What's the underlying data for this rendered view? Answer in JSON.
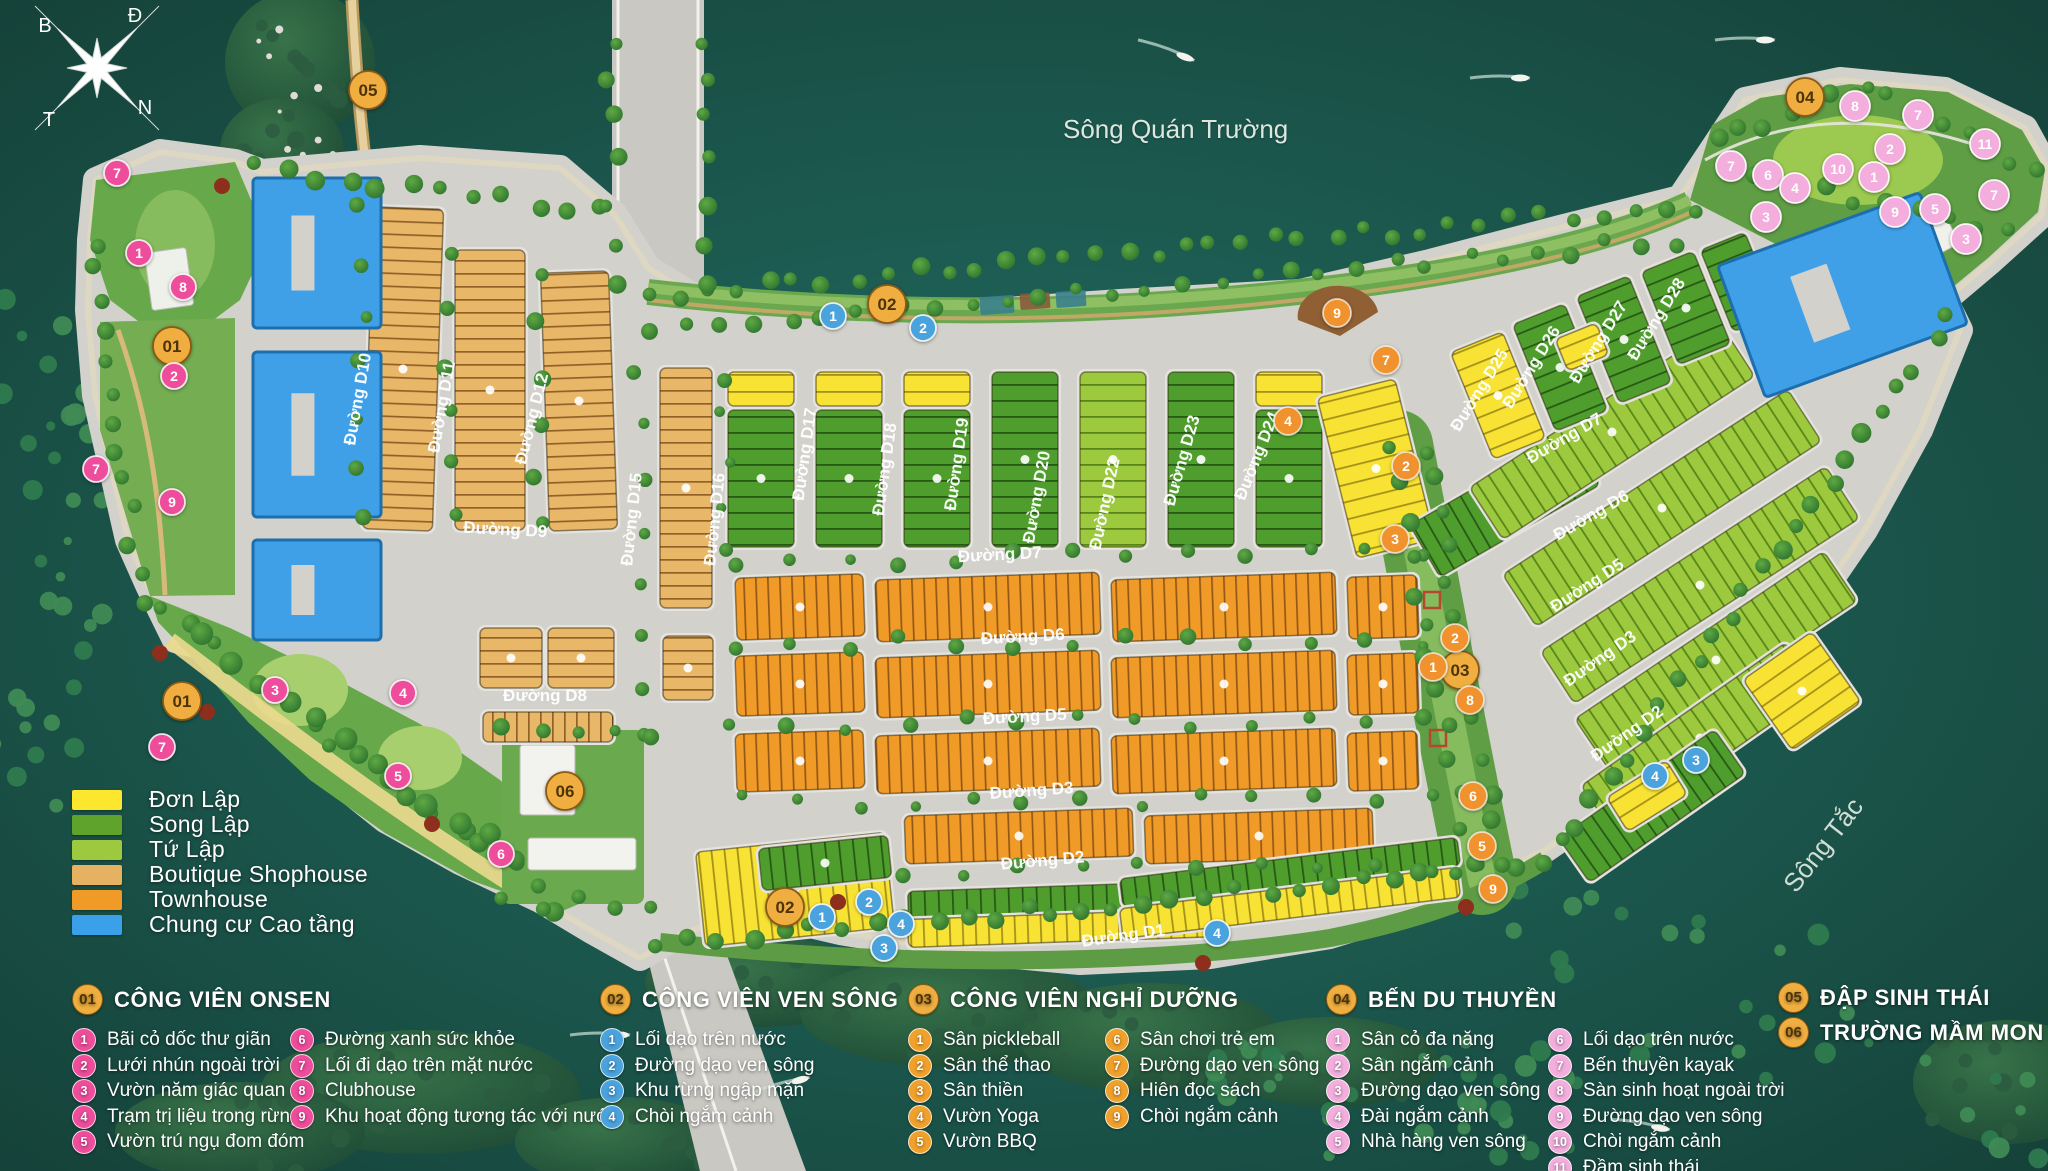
{
  "map": {
    "river_top": "Sông Quán Trường",
    "river_right": "Sông Tắc",
    "compass": {
      "top_left": "B",
      "top_right": "Đ",
      "bottom_left": "T",
      "bottom_right": "N"
    }
  },
  "legend": {
    "items": [
      {
        "label": "Đơn Lập",
        "color": "#fce62e"
      },
      {
        "label": "Song Lập",
        "color": "#5fa32c"
      },
      {
        "label": "Tứ Lập",
        "color": "#9cc93e"
      },
      {
        "label": "Boutique Shophouse",
        "color": "#e6b261"
      },
      {
        "label": "Townhouse",
        "color": "#f09b27"
      },
      {
        "label": "Chung cư Cao tầng",
        "color": "#3ba0ea"
      }
    ]
  },
  "poi_sections": [
    {
      "id": "01",
      "title": "CÔNG VIÊN ONSEN",
      "badge_color": "#ee4d9b",
      "items": [
        "Bãi cỏ dốc thư giãn",
        "Lưới nhún ngoài trời",
        "Vườn năm giác quan",
        "Trạm trị liệu trong rừng",
        "Vườn trú ngụ đom đóm",
        "Đường xanh sức khỏe",
        "Lối đi dạo trên mặt nước",
        "Clubhouse",
        "Khu hoạt động tương tác với nước"
      ]
    },
    {
      "id": "02",
      "title": "CÔNG VIÊN VEN SÔNG",
      "badge_color": "#4aa3dd",
      "items": [
        "Lối dạo trên nước",
        "Đường dạo ven sông",
        "Khu rừng ngập mặn",
        "Chòi ngắm cảnh"
      ]
    },
    {
      "id": "03",
      "title": "CÔNG VIÊN NGHỈ DƯỠNG",
      "badge_color": "#f0a12c",
      "items": [
        "Sân pickleball",
        "Sân thể thao",
        "Sân thiền",
        "Vườn Yoga",
        "Vườn BBQ",
        "Sân chơi trẻ em",
        "Đường dạo ven sông",
        "Hiên đọc sách",
        "Chòi ngắm cảnh"
      ]
    },
    {
      "id": "04",
      "title": "BẾN DU THUYỀN",
      "badge_color": "#f3aedd",
      "items": [
        "Sân cỏ đa năng",
        "Sân ngắm cảnh",
        "Đường dạo ven sông",
        "Đài ngắm cảnh",
        "Nhà hàng ven sông",
        "Lối dạo trên nước",
        "Bến thuyền kayak",
        "Sàn sinh hoạt ngoài trời",
        "Đường dạo ven sông",
        "Chòi ngắm cảnh",
        "Đầm sinh thái"
      ]
    },
    {
      "id": "05",
      "title": "ĐẬP SINH THÁI",
      "badge_color": "#efae3f",
      "items": []
    },
    {
      "id": "06",
      "title": "TRƯỜNG MẦM MON",
      "badge_color": "#efae3f",
      "items": []
    }
  ],
  "roads": {
    "d1": "Đường D1",
    "d2": "Đường D2",
    "d3": "Đường D3",
    "d5": "Đường D5",
    "d6": "Đường D6",
    "d7": "Đường D7",
    "d8": "Đường D8",
    "d9": "Đường D9",
    "d10": "Đường D10",
    "d11": "Đường D11",
    "d12": "Đường D12",
    "d15": "Đường D15",
    "d16": "Đường D16",
    "d17": "Đường D17",
    "d18": "Đường D18",
    "d19": "Đường D19",
    "d20": "Đường D20",
    "d22": "Đường D22",
    "d23": "Đường D23",
    "d24": "Đường D24",
    "d25": "Đường D25",
    "d26": "Đường D26",
    "d27": "Đường D27",
    "d28": "Đường D28"
  },
  "markers": {
    "gold": [
      {
        "n": "01",
        "x": 172,
        "y": 346
      },
      {
        "n": "01",
        "x": 182,
        "y": 701
      },
      {
        "n": "02",
        "x": 887,
        "y": 304
      },
      {
        "n": "02",
        "x": 785,
        "y": 907
      },
      {
        "n": "03",
        "x": 1460,
        "y": 670
      },
      {
        "n": "04",
        "x": 1805,
        "y": 97
      },
      {
        "n": "05",
        "x": 368,
        "y": 90
      },
      {
        "n": "06",
        "x": 565,
        "y": 791
      }
    ],
    "pink": [
      {
        "n": "7",
        "x": 117,
        "y": 173
      },
      {
        "n": "1",
        "x": 139,
        "y": 253
      },
      {
        "n": "8",
        "x": 183,
        "y": 287
      },
      {
        "n": "2",
        "x": 174,
        "y": 376
      },
      {
        "n": "7",
        "x": 96,
        "y": 469
      },
      {
        "n": "9",
        "x": 172,
        "y": 502
      },
      {
        "n": "3",
        "x": 275,
        "y": 690
      },
      {
        "n": "4",
        "x": 403,
        "y": 693
      },
      {
        "n": "5",
        "x": 398,
        "y": 776
      },
      {
        "n": "7",
        "x": 162,
        "y": 747
      },
      {
        "n": "6",
        "x": 501,
        "y": 854
      }
    ],
    "blue": [
      {
        "n": "1",
        "x": 833,
        "y": 316
      },
      {
        "n": "2",
        "x": 923,
        "y": 328
      },
      {
        "n": "1",
        "x": 822,
        "y": 917
      },
      {
        "n": "2",
        "x": 869,
        "y": 902
      },
      {
        "n": "3",
        "x": 884,
        "y": 948
      },
      {
        "n": "4",
        "x": 901,
        "y": 924
      },
      {
        "n": "4",
        "x": 1217,
        "y": 933
      },
      {
        "n": "3",
        "x": 1696,
        "y": 760
      },
      {
        "n": "4",
        "x": 1655,
        "y": 776
      }
    ],
    "orange": [
      {
        "n": "9",
        "x": 1337,
        "y": 313
      },
      {
        "n": "7",
        "x": 1386,
        "y": 360
      },
      {
        "n": "4",
        "x": 1288,
        "y": 421
      },
      {
        "n": "2",
        "x": 1406,
        "y": 466
      },
      {
        "n": "3",
        "x": 1395,
        "y": 539
      },
      {
        "n": "2",
        "x": 1455,
        "y": 638
      },
      {
        "n": "1",
        "x": 1433,
        "y": 667
      },
      {
        "n": "8",
        "x": 1470,
        "y": 700
      },
      {
        "n": "6",
        "x": 1473,
        "y": 796
      },
      {
        "n": "5",
        "x": 1482,
        "y": 846
      },
      {
        "n": "9",
        "x": 1493,
        "y": 889
      }
    ],
    "marina": [
      {
        "n": "8",
        "x": 1855,
        "y": 106
      },
      {
        "n": "7",
        "x": 1918,
        "y": 115
      },
      {
        "n": "11",
        "x": 1985,
        "y": 144
      },
      {
        "n": "7",
        "x": 1731,
        "y": 166
      },
      {
        "n": "6",
        "x": 1768,
        "y": 175
      },
      {
        "n": "2",
        "x": 1890,
        "y": 149
      },
      {
        "n": "10",
        "x": 1838,
        "y": 169
      },
      {
        "n": "1",
        "x": 1874,
        "y": 177
      },
      {
        "n": "4",
        "x": 1795,
        "y": 188
      },
      {
        "n": "3",
        "x": 1766,
        "y": 217
      },
      {
        "n": "9",
        "x": 1895,
        "y": 212
      },
      {
        "n": "5",
        "x": 1935,
        "y": 209
      },
      {
        "n": "3",
        "x": 1966,
        "y": 239
      },
      {
        "n": "7",
        "x": 1994,
        "y": 195
      }
    ]
  },
  "colors": {
    "water": "#1f5f55",
    "island": "#d2d1cb",
    "park": "#67a84b",
    "gold_marker": "#efae3f",
    "pink_marker": "#ee4d9b",
    "blue_marker": "#4aa3dd",
    "orange_marker": "#f0922d",
    "marina_marker": "#f3aedd"
  }
}
